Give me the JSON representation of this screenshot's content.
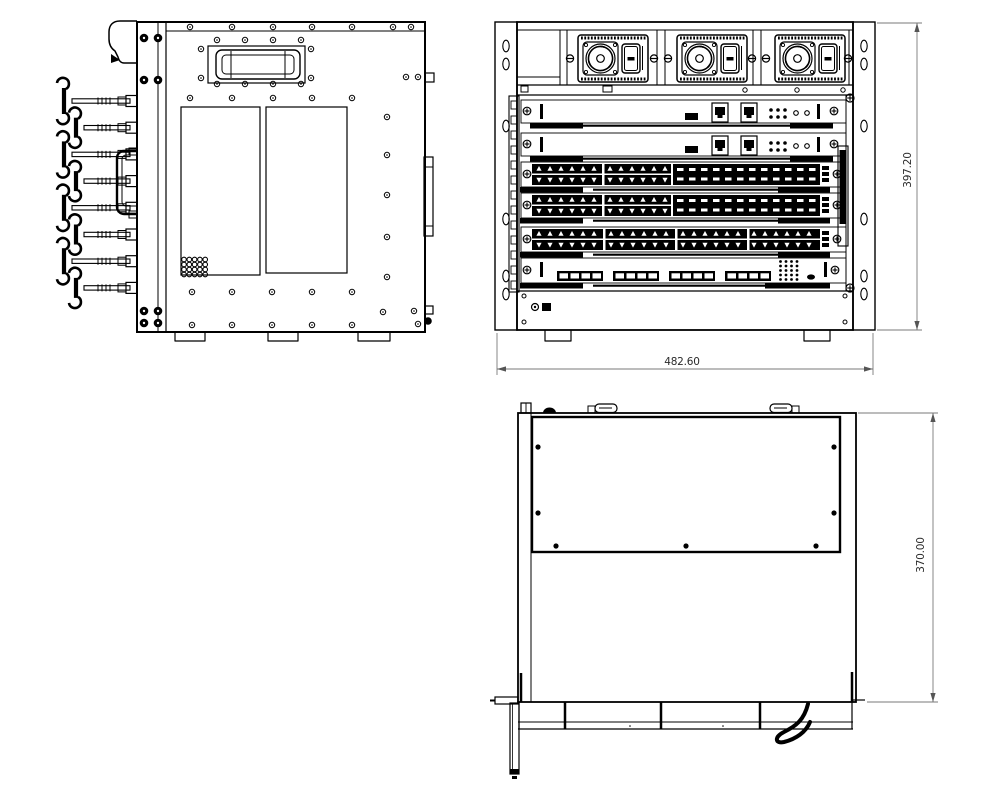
{
  "drawing": {
    "title": "Three-view mechanical drawing of a rack-mount modular switch chassis",
    "background": "#ffffff",
    "ink": "#000000",
    "dim_line_color": "#7a7a7a",
    "dim_text_color": "#2a2a2a",
    "views": [
      {
        "id": "side",
        "label": "left-side-view"
      },
      {
        "id": "front",
        "label": "front-view"
      },
      {
        "id": "top",
        "label": "top-view"
      }
    ],
    "dimensions": [
      {
        "id": "front-width",
        "text": "482.60",
        "orientation": "horizontal"
      },
      {
        "id": "front-height",
        "text": "397.20",
        "orientation": "vertical"
      },
      {
        "id": "top-depth",
        "text": "370.00",
        "orientation": "vertical"
      }
    ],
    "front": {
      "psu_modules": 3,
      "flange_hole_ys": [
        46,
        64,
        126,
        219,
        276,
        294
      ],
      "slots": [
        {
          "type": "supervisor-card",
          "rj45_ports": 2
        },
        {
          "type": "supervisor-card",
          "rj45_ports": 2
        },
        {
          "type": "line-card-mixed",
          "rj45_ports": 24,
          "sfp_ports": 24
        },
        {
          "type": "line-card-mixed",
          "rj45_ports": 24,
          "sfp_ports": 24
        },
        {
          "type": "line-card-rj45",
          "rj45_ports": 48
        },
        {
          "type": "uplink-card-sfp",
          "sfp_ports": 16
        }
      ]
    },
    "side": {
      "cable_hooks": 8
    },
    "top": {
      "vent_panel_screws": 7
    }
  }
}
